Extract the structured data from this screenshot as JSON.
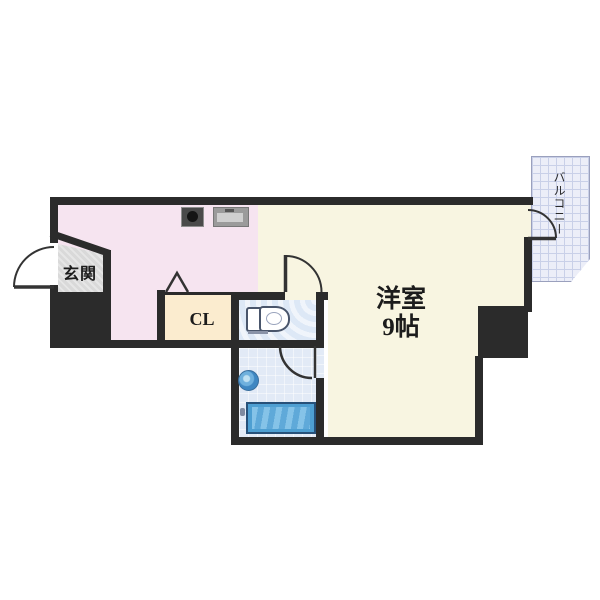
{
  "plan": {
    "type_note": "apartment floor plan",
    "entrance_label": "玄関",
    "closet_label": "CL",
    "main_room_label": "洋室",
    "main_room_size": "9帖",
    "balcony_label": "バルコニー"
  },
  "colors": {
    "wall": "#2b2b2b",
    "kitchen": "#f6e4f0",
    "room": "#f8f5e1",
    "closet": "#fbeccf",
    "toilet": "#dde8f6",
    "bath": "#e2eaf6",
    "tile": "#d9d9d9",
    "balcony": "#eceef8",
    "balcony-line": "#c9d0e8",
    "tub": "#4e9fd2",
    "tub-inner": "#85c3e8",
    "fixture": "#49556b",
    "accent": "#333333"
  }
}
